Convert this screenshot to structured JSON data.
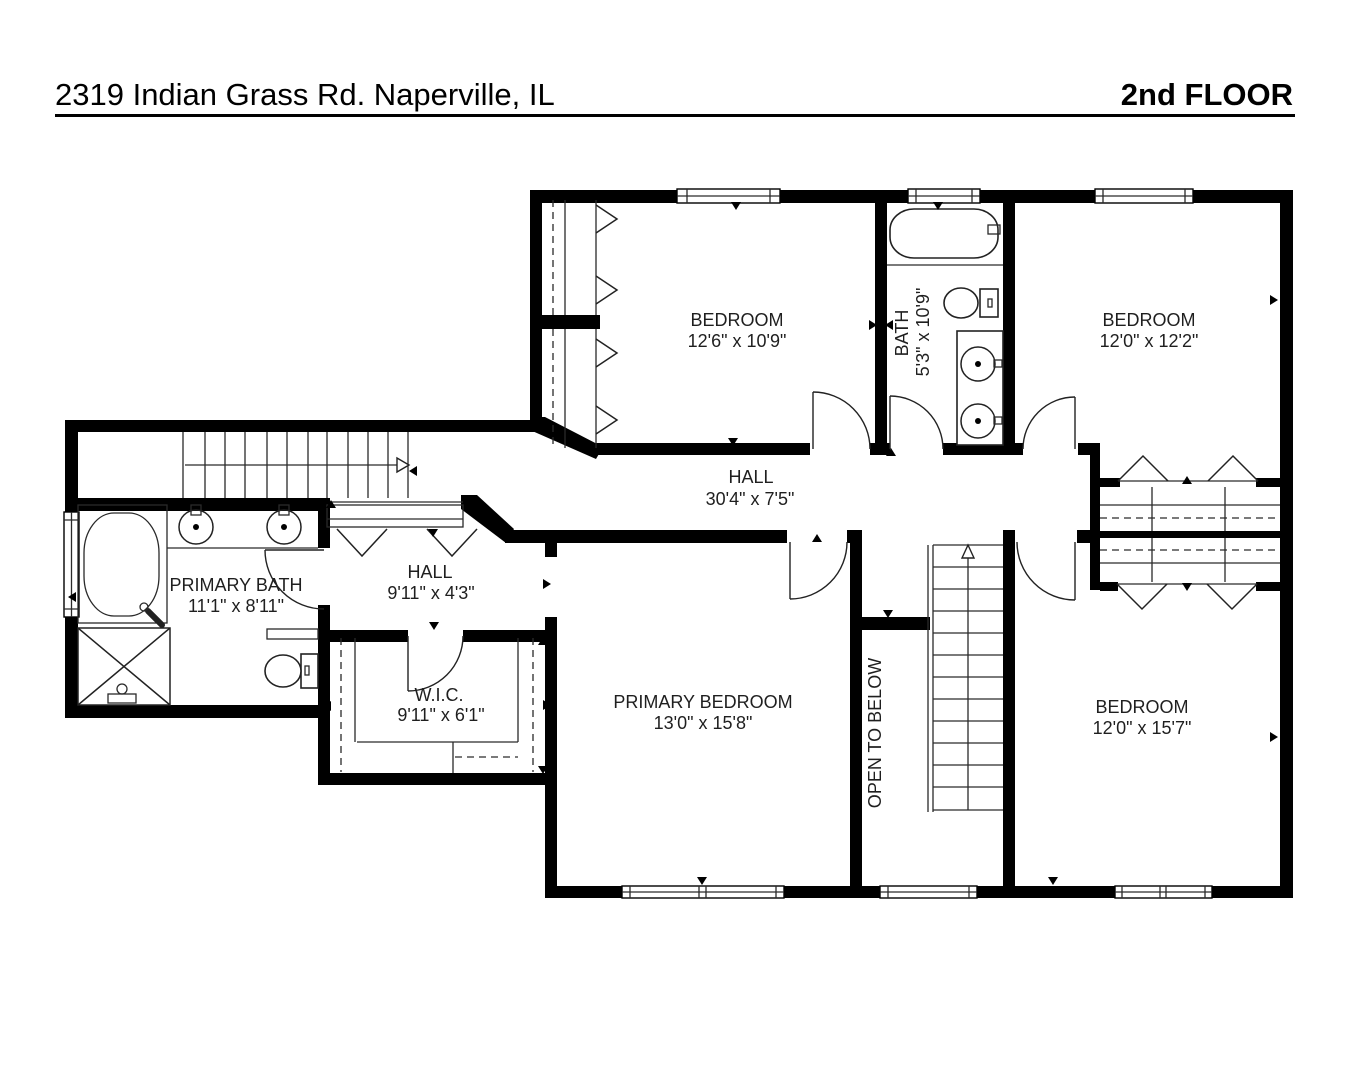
{
  "header": {
    "address": "2319 Indian Grass Rd. Naperville, IL",
    "floor_label": "2nd FLOOR"
  },
  "colors": {
    "ink": "#000000",
    "paper": "#ffffff",
    "label_text": "#1f1f1f"
  },
  "rooms": {
    "bedroom_top": {
      "name": "BEDROOM",
      "dims": "12'6\" x 10'9\""
    },
    "bath": {
      "name": "BATH",
      "dims": "5'3\" x 10'9\""
    },
    "bedroom_right": {
      "name": "BEDROOM",
      "dims": "12'0\" x 12'2\""
    },
    "hall_main": {
      "name": "HALL",
      "dims": "30'4\" x 7'5\""
    },
    "primary_bath": {
      "name": "PRIMARY BATH",
      "dims": "11'1\" x 8'11\""
    },
    "hall_small": {
      "name": "HALL",
      "dims": "9'11\" x 4'3\""
    },
    "wic": {
      "name": "W.I.C.",
      "dims": "9'11\" x 6'1\""
    },
    "primary_bedroom": {
      "name": "PRIMARY BEDROOM",
      "dims": "13'0\" x 15'8\""
    },
    "open_to_below": {
      "name": "OPEN TO BELOW"
    },
    "bedroom_bottom_right": {
      "name": "BEDROOM",
      "dims": "12'0\" x 15'7\""
    }
  }
}
